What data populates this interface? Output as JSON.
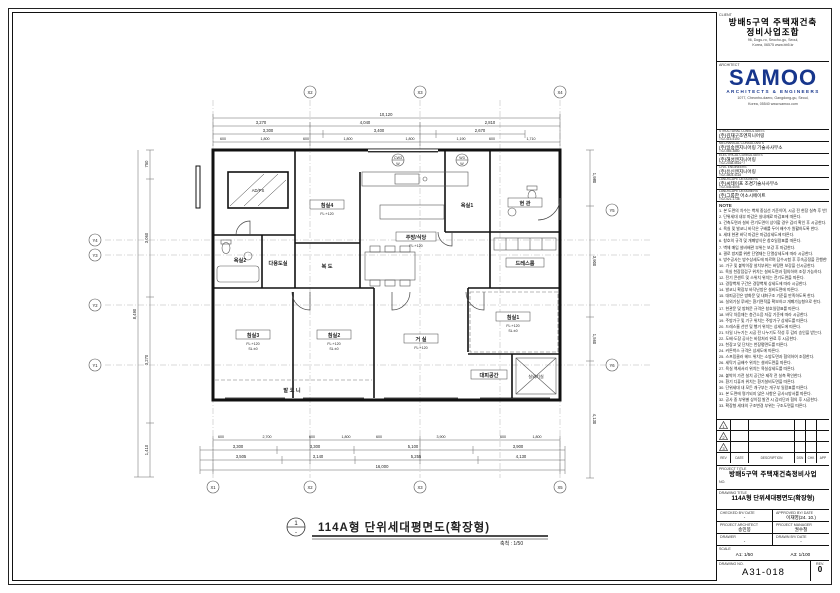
{
  "client": {
    "label": "CLIENT",
    "name_line1": "방배5구역 주택재건축",
    "name_line2": "정비사업조합",
    "address": "96, Dogu-ro, Seocho-gu, Seoul,",
    "address2": "Korea, 06575  www.bb5.kr"
  },
  "architect": {
    "label": "ARCHITECT",
    "logo_text": "SAMOO",
    "tagline": "ARCHITECTS & ENGINEERS",
    "brand_color": "#17368c",
    "address": "1077, Cheonho-daero, Gangdong-gu, Seoul,",
    "address2": "Korea, 05540  www.samoo.com"
  },
  "consultants": [
    {
      "role": "STRUCTURAL CONSULTANTS",
      "name": "(주)김재구조엔지니어링",
      "tel": "T:02-415-5100"
    },
    {
      "role": "MECHANICAL CONSULTANTS",
      "name": "(주)일송엔지니어링 기술사사무소",
      "tel": "T:02-565-3880"
    },
    {
      "role": "ELECTRICAL CONSULTANTS",
      "name": "(주)해성엔지니어링",
      "tel": "T:02-2038-5616~7"
    },
    {
      "role": "CIVIL ENGINEERS",
      "name": "(주)유신엔지니어링",
      "tel": "T:02-3803-4118"
    },
    {
      "role": "LANDSCAPE DESIGNERS",
      "name": "(주)씨테이프 조경기술사사무소",
      "tel": "T:02-545-6094"
    },
    {
      "role": "LANDSCAPE DESIGNERS",
      "name": "(주)그룹한 어소시에이트",
      "tel": "T:02-521-1738"
    }
  ],
  "notes": {
    "label": "NOTE",
    "items": [
      "1. 본 도면의 치수는 벽체 중심선 기준이며, 시공 전 현장 실측 후 반영한다.",
      "2. 단위세대 내부 마감은 실내재료 마감표에 따른다.",
      "3. 건축도면과 설비·전기도면이 상이할 경우 감리 확인 후 시공한다.",
      "4. 욕실 및 발코니 바닥은 구배를 두어 배수가 원활하도록 한다.",
      "5. 세대 현관 바닥 마감은 마감상세도에 따른다.",
      "6. 창호의 규격 및 개폐방식은 창호일람표를 따른다.",
      "7. 벽체 매입 설비배관 부위는 보강 후 마감한다.",
      "8. 결로 방지를 위한 단열재는 단열상세도에 따라 시공한다.",
      "9. 방수공사는 방수상세도에 따르며 담수시험 후 후속공정을 진행한다.",
      "10. 가구 및 붙박이장 설치부위는 바탕면 보강을 선시공한다.",
      "11. 욕실 천장점검구 위치는 설비도면과 협의하여 조정 가능하다.",
      "12. 전기 콘센트 및 스위치 위치는 전기도면을 따른다.",
      "13. 경량벽체 구간은 경량벽체 상세도에 따라 시공한다.",
      "14. 발코니 확장부 바닥난방은 설비도면에 따른다.",
      "15. 대피공간은 방화문 및 내화구조 기준을 만족하도록 한다.",
      "16. 실외기실 루버는 환기면적을 확보하고 개폐가능형으로 한다.",
      "17. 현관문 및 방화문 규격은 창호일람표를 따른다.",
      "18. 바닥 차음재는 층간소음 저감 기준에 따라 시공한다.",
      "19. 주방가구 및 기구 위치는 주방가구 상세도를 따른다.",
      "20. 드레스룸 선반 및 행거 위치는 상세도에 따른다.",
      "21. 타일 나누기는 시공 전 나누기도 작성 후 감리 승인을 받는다.",
      "22. 도배·도장 공사는 바탕처리 완료 후 시공한다.",
      "23. 천장고 및 단차는 천장평면도를 따른다.",
      "24. 커튼박스 규격은 상세도에 따른다.",
      "25. 스프링클러 헤드 위치는 소방도면과 협의하여 조정한다.",
      "26. 세탁기 급배수 위치는 설비도면을 따른다.",
      "27. 욕실 액세서리 위치는 욕실상세도를 따른다.",
      "28. 붙박이 가전 설치 공간은 제작 전 실측 확인한다.",
      "29. 환기 디퓨저 위치는 환기설비도면을 따른다.",
      "30. 단위세대 내 모든 개구부는 개구부 일람표를 따른다.",
      "31. 본 도면에 명기되지 않은 사항은 공사시방서를 따른다.",
      "32. 공사 중 부위별 상이점 발견 시 감리단과 협의 후 시공한다.",
      "33. 확장형 세대의 구조변경 부위는 구조도면을 따른다."
    ]
  },
  "revision": {
    "headers": {
      "rev": "REV",
      "date": "DATE",
      "description": "DESCRIPTION",
      "dsn": "DSN",
      "chk": "CHK",
      "app": "APP"
    },
    "marks": [
      "1",
      "2",
      "3"
    ]
  },
  "project": {
    "label": "PROJECT TITLE",
    "title": "방배5구역 주택재건축정비사업",
    "no_label": "NO."
  },
  "drawing": {
    "label": "DRAWING TITLE",
    "title": "114A형 단위세대평면도(확장형)"
  },
  "signoff": {
    "checked_label": "CHECKED BY/ DATE",
    "checked": "-",
    "approved_label": "APPROVED BY/ DATE",
    "approved": "이재영(24. 10.)",
    "pa_label": "PROJECT ARCHITECT",
    "pa": "송민봉",
    "pm_label": "PROJECT MANAGER",
    "pm": "권수철",
    "drawer_label": "DRAWER",
    "drawer": "-",
    "drawn_label": "DRAWN BY/ DATE",
    "drawn": "-"
  },
  "scale": {
    "label": "SCALE",
    "a1": "A1: 1/50",
    "a3": "A3: 1/100"
  },
  "dwg_no": {
    "label": "DRAWING NO.",
    "value": "A31-018",
    "rev_label": "REV.",
    "rev": "0"
  },
  "plan": {
    "title_no": "1",
    "title_dash": "-",
    "title": "114A형 단위세대평면도(확장형)",
    "scale_note": "축척 : 1/50",
    "rooms": {
      "bed1": "침실1",
      "bed2": "침실2",
      "bed3": "침실3",
      "bed4": "침실4",
      "living": "거 실",
      "kitchen": "주방/식당",
      "entry": "현 관",
      "bath1": "욕실1",
      "bath2": "욕실2",
      "dress": "드레스룸",
      "util": "다용도실",
      "balcony": "발 코 니",
      "evac": "대피공간",
      "acunit": "실외기실",
      "hall": "복 도",
      "core": "AD/PS"
    },
    "level_fl": "FL:+120",
    "level_sl": "SL:±0",
    "dims_top1": "10,120",
    "dims_top2": [
      "3,270",
      "4,040",
      "2,810"
    ],
    "dims_top3": [
      "3,300",
      "3,400",
      "2,670"
    ],
    "dims_top4": [
      "600",
      "1,800",
      "600",
      "1,800",
      "1,800",
      "1,190",
      "600",
      "1,710"
    ],
    "dims_bot1": [
      "600",
      "2,700",
      "600",
      "1,800",
      "600",
      "3,900",
      "600",
      "1,800"
    ],
    "dims_bot2": [
      "3,300",
      "3,300",
      "5,100",
      "3,900"
    ],
    "dims_bot3": [
      "3,505",
      "3,140",
      "5,255",
      "4,130"
    ],
    "dims_bot4": "16,000",
    "dims_left": [
      "750",
      "3,060",
      "3,270",
      "1,410"
    ],
    "dims_left_total": "8,490",
    "dims_right": [
      "1,980",
      "3,900",
      "1,560",
      "4,130"
    ],
    "grid_top": [
      "X2",
      "X3",
      "X4"
    ],
    "grid_bottom": [
      "X1",
      "X2",
      "X3",
      "X5"
    ],
    "grid_left": [
      "Y4",
      "Y3",
      "Y2",
      "Y1"
    ],
    "grid_right": [
      "Y5",
      "Y6"
    ],
    "win_tag1a": "CW3",
    "win_tag1b": "W",
    "win_tag2a": "W3",
    "win_tag2b": "W"
  }
}
